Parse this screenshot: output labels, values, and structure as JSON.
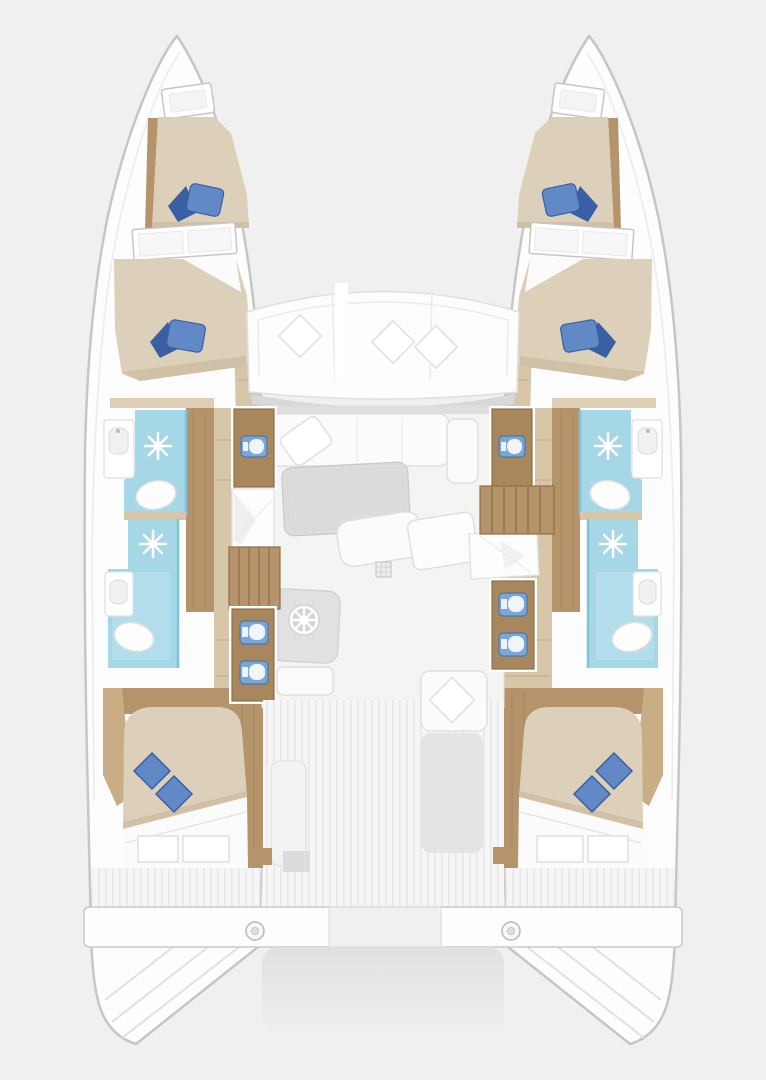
{
  "meta": {
    "title": "Catamaran Floor Plan",
    "view": "top-down interior layout, no text labels visible"
  },
  "colors": {
    "bg": "#f0f0f0",
    "hull_fill": "#fdfdfd",
    "hull_stroke": "#c6c6c6",
    "line_soft": "#e0e0e0",
    "line_faint": "#ebebeb",
    "deck_shadow": "#d8d8d8",
    "floor": "#f4f4f3",
    "white": "#ffffff",
    "soft_white": "#fbfbfb",
    "gray_panel": "#e1e1e1",
    "gray_seat": "#e4e4e4",
    "table_gray": "#dcdcdc",
    "platform_dark": "#e0e0e0",
    "platform_light": "#efefef",
    "stripe": "#e7e7e7",
    "stripe_bg": "#f6f6f6",
    "wood": "#a9875c",
    "wood_dark": "#8d6f49",
    "wood_mid": "#b5946c",
    "wood_light": "#c8ad85",
    "wood_pale": "#d8c6a9",
    "bed": "#ddd0bb",
    "bed_shade": "#cfc0a6",
    "pillow": "#6189c6",
    "pillow_dark": "#3a5fa3",
    "shower": "#a6d7e6",
    "shower_pale": "#bfe2ee",
    "shower_deep": "#7fc3da",
    "toilet": "#fdfdfd",
    "sink_blue": "#7aa7d8",
    "sink_blue_dark": "#4a77b0",
    "basin_white": "#f0f5fa"
  },
  "regions": {
    "port_hull": {
      "label": "Port hull (left)",
      "rooms": [
        "forward cabin with berth",
        "mid cabin with berth",
        "forward head with shower and toilet",
        "aft head with shower and toilet",
        "aft double cabin",
        "stern deck with transom steps"
      ]
    },
    "starboard_hull": {
      "label": "Starboard hull (right)",
      "mirrored": true,
      "rooms": [
        "forward cabin with berth",
        "mid cabin with berth",
        "forward head with shower and toilet",
        "aft head with shower and toilet",
        "aft double cabin",
        "stern deck with transom steps"
      ]
    },
    "bridgedeck": {
      "label": "Center bridgedeck",
      "areas": [
        "forward cockpit bench with three pillows",
        "salon sofa, table and bench",
        "helm console with wheel",
        "twin vanity sink cabinets",
        "port and starboard stair wells",
        "galley sink counters",
        "aft cockpit with benches",
        "aft crossbeam with two winches",
        "swim platform"
      ]
    }
  },
  "inventory": {
    "hulls": 2,
    "double_berths": 6,
    "blue_pillows": 12,
    "white_pillows": 5,
    "shower_stalls": 4,
    "toilets": 4,
    "head_washbasins": 4,
    "blue_counter_sinks": 6,
    "staircases": 2,
    "helm_wheels": 1,
    "deck_hatches": 2,
    "winches": 2,
    "stern_windows_per_aft_cabin": 2
  }
}
